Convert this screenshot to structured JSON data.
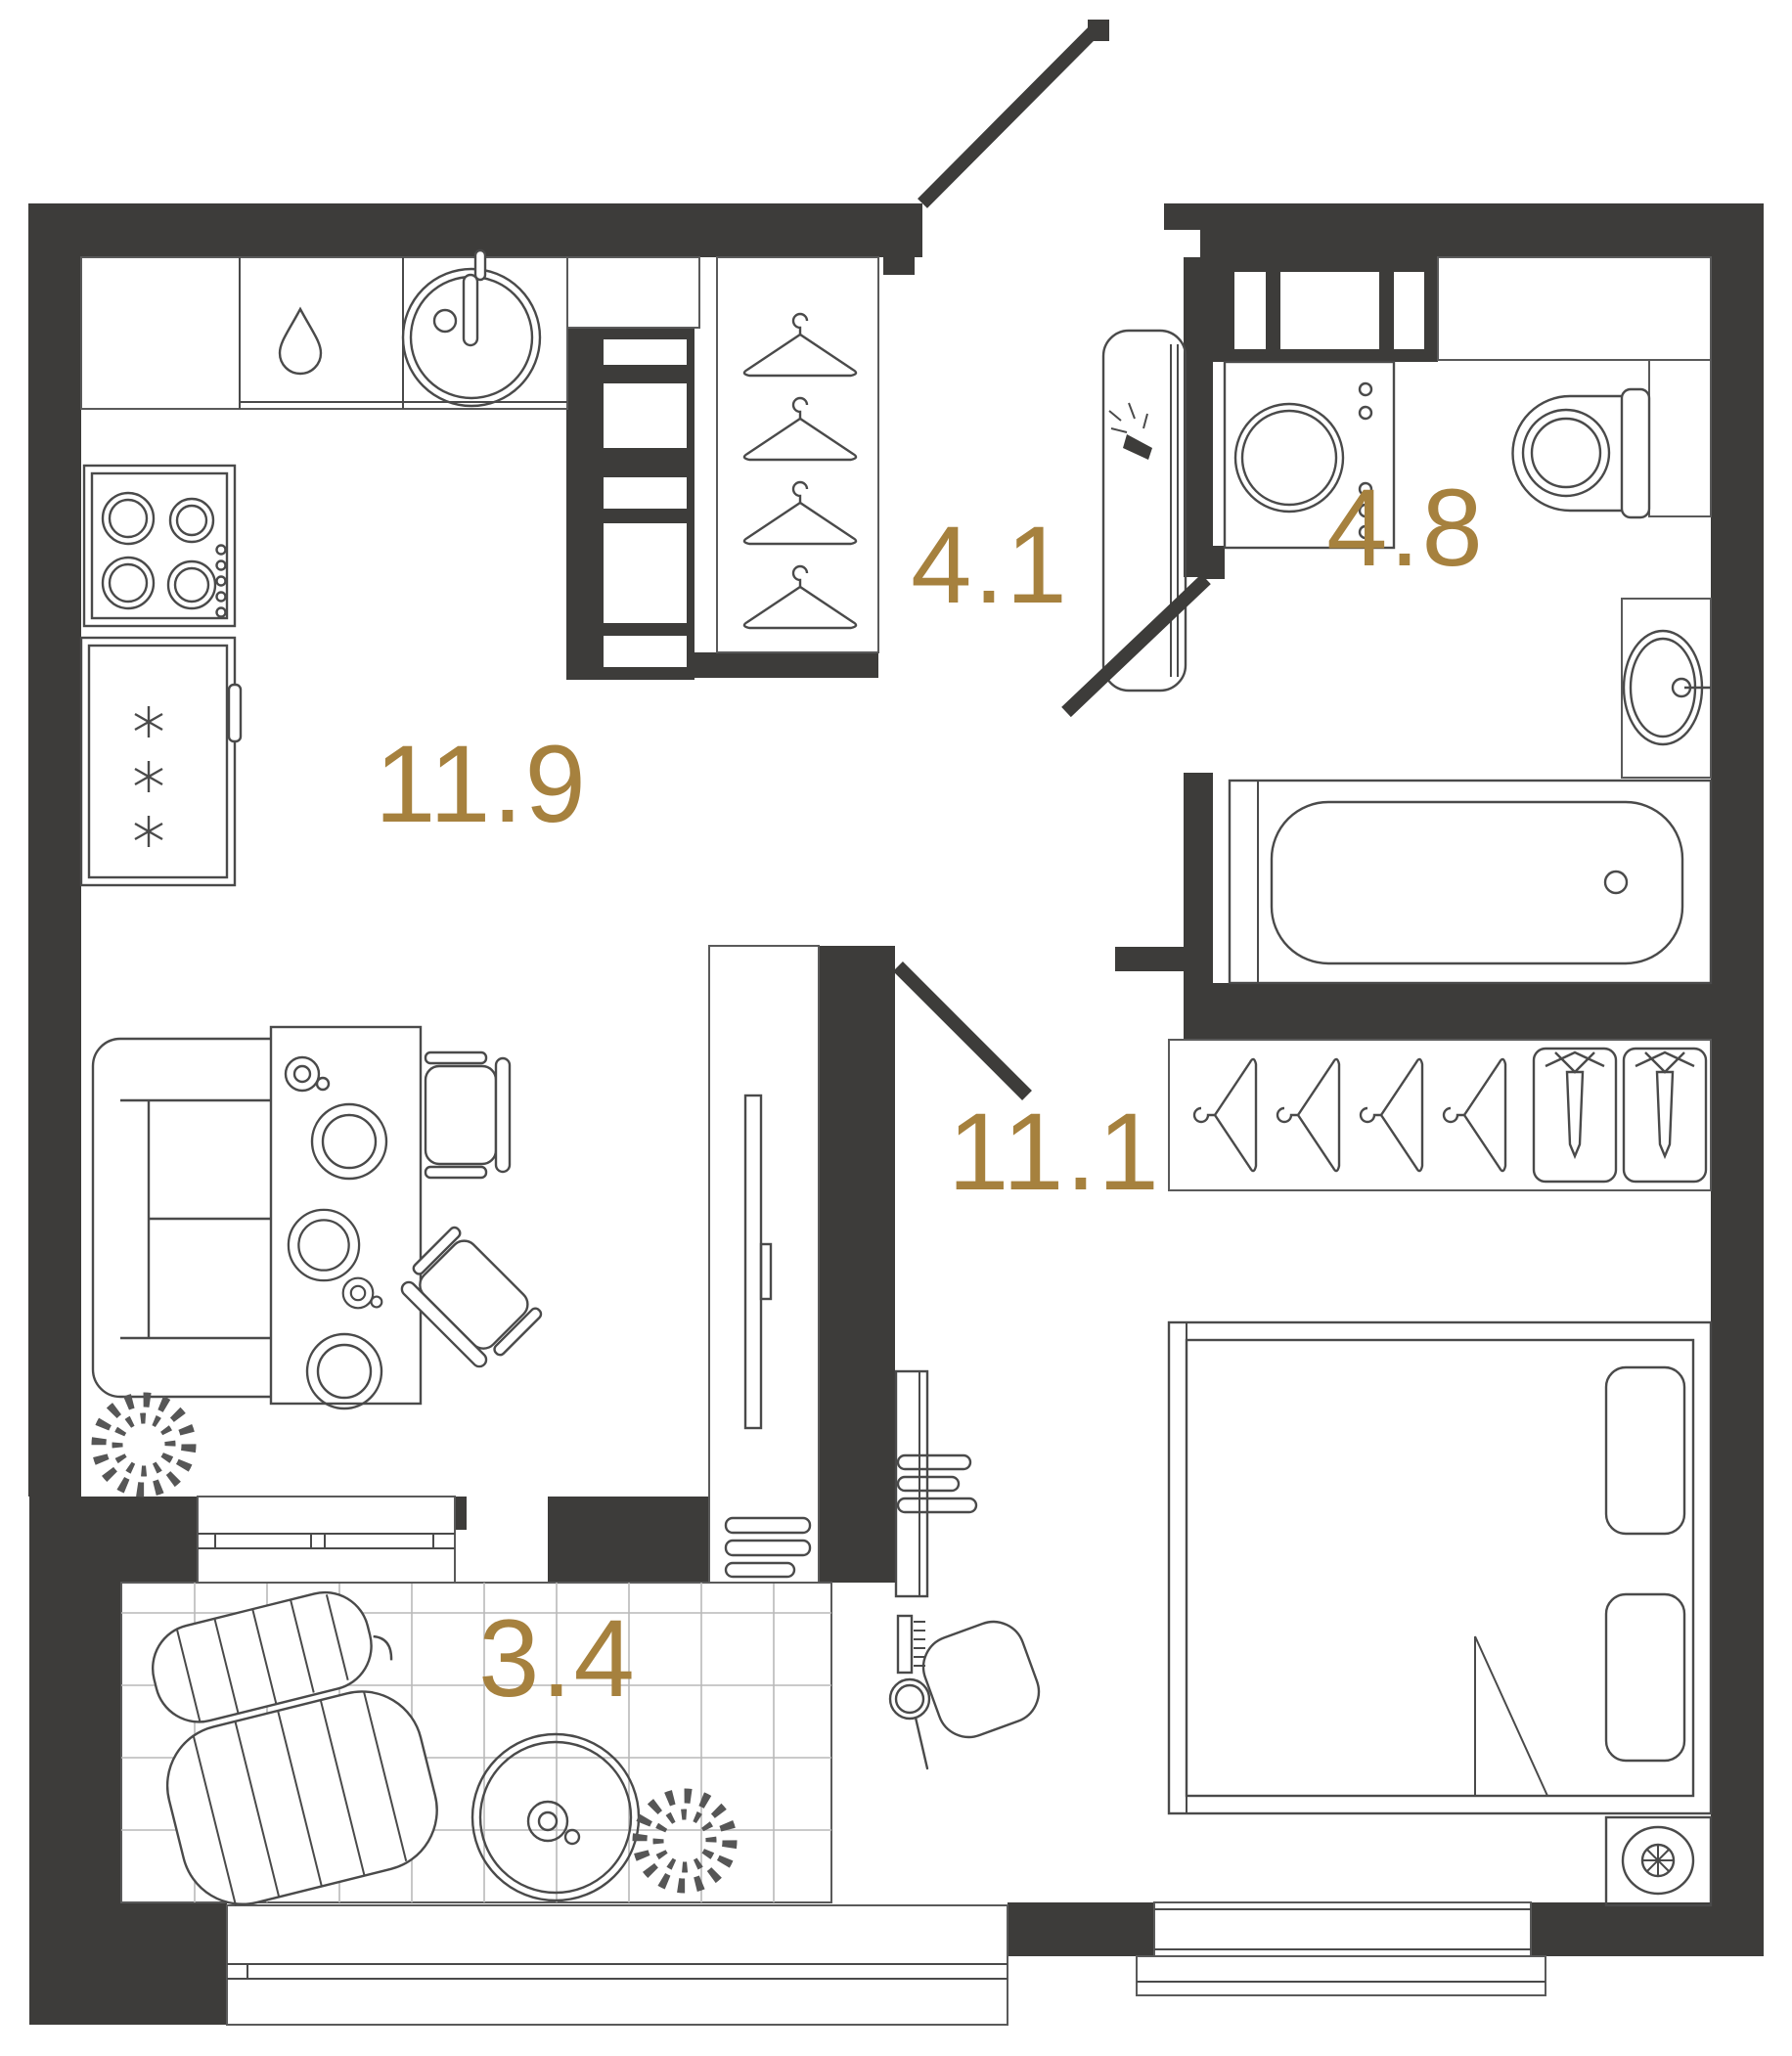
{
  "plan": {
    "kind": "apartment-floor-plan",
    "units": "square-meters-implied",
    "room_count": 5
  },
  "rooms": [
    {
      "id": "kitchen-living-room",
      "area_label": "11.9"
    },
    {
      "id": "entrance-hall",
      "area_label": "4.1"
    },
    {
      "id": "bathroom",
      "area_label": "4.8"
    },
    {
      "id": "bedroom",
      "area_label": "11.1"
    },
    {
      "id": "balcony",
      "area_label": "3.4"
    }
  ],
  "colors": {
    "wall": "#3d3c3a",
    "room_label": "#a6813e",
    "furniture_line": "#4a4a4a",
    "background": "#ffffff",
    "tile_line": "#b9b9b9"
  },
  "icons": {
    "hanger-icon": "clothes hanger outline",
    "shirt-tie-icon": "folded shirt with tie",
    "snowflake-icon": "fridge freezer asterisk",
    "water-drop-icon": "dishwasher drop",
    "plant-icon": "leafy plant wreath",
    "fan-icon": "circle with spokes",
    "sconce-icon": "wall lamp burst"
  }
}
